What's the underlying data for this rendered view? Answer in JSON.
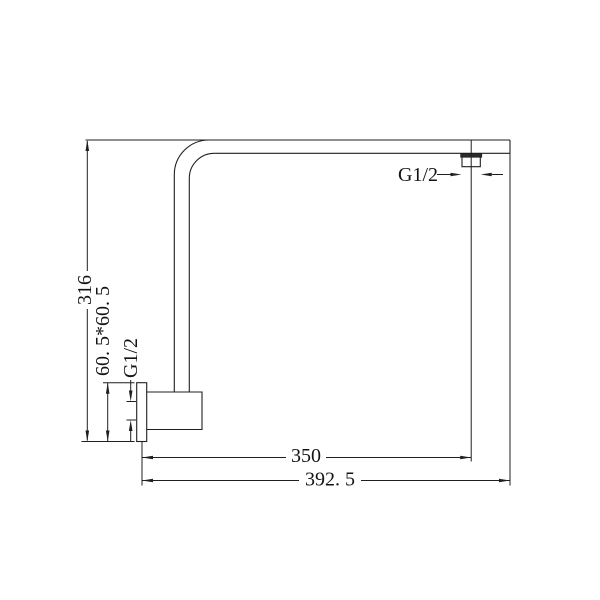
{
  "drawing": {
    "kind": "technical-dimension-drawing",
    "background": "#ffffff",
    "line_color": "#1f1f1f",
    "labels": {
      "overall_height": "316",
      "flange_size": "60. 5*60. 5",
      "inlet_thread": "G1/2",
      "outlet_thread": "G1/2",
      "outlet_reach": "350",
      "overall_reach": "392. 5"
    }
  }
}
